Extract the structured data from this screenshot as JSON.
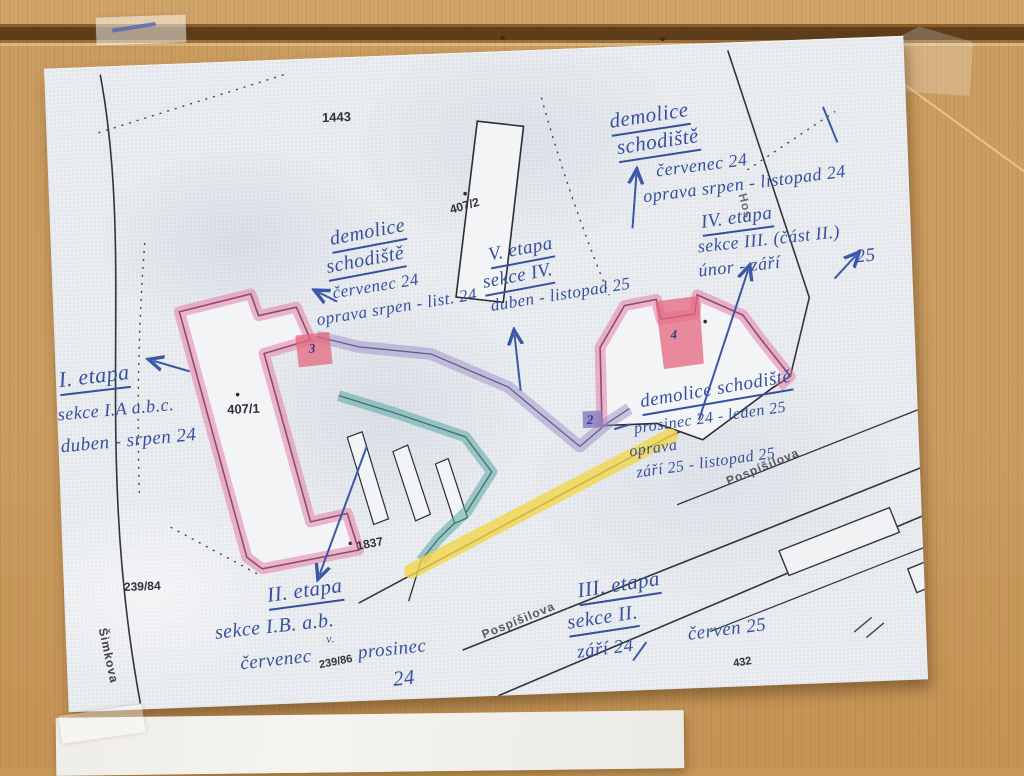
{
  "photo": {
    "wood_color": "#c79758",
    "paper_color": "#edeff1"
  },
  "map": {
    "parcels": [
      {
        "label": "1443"
      },
      {
        "label": "407/2"
      },
      {
        "label": "407/1"
      },
      {
        "label": "1837"
      },
      {
        "label": "239/84"
      },
      {
        "label": "239/86"
      },
      {
        "label": "432"
      }
    ],
    "streets": [
      {
        "name": "Šimkova"
      },
      {
        "name": "Pospíšilova"
      },
      {
        "name": "Pospíšilova"
      },
      {
        "name": "Hos"
      }
    ],
    "stair_markers": [
      {
        "num": "3"
      },
      {
        "num": "4"
      },
      {
        "num": "2"
      }
    ],
    "legend_colors": {
      "pink": "#e671a2",
      "red": "#e4677e",
      "lavender": "#9c8fc9",
      "teal": "#58a8a2",
      "yellow": "#f3d64a",
      "ink": "#3a57a8"
    }
  },
  "annotations": {
    "a1": {
      "l1": "demolice",
      "l2": "schodiště",
      "l3": "červenec 24",
      "l4": "oprava srpen - listopad 24"
    },
    "a2": {
      "l1": "demolice",
      "l2": "schodiště",
      "l3": "červenec 24",
      "l4": "oprava srpen - list. 24"
    },
    "a3": {
      "l1": "V. etapa",
      "l2": "sekce IV.",
      "l3": "duben - listopad 25"
    },
    "a4": {
      "l1": "IV. etapa",
      "l2": "sekce III. (část II.)",
      "l3": "únor - září",
      "l4": "25"
    },
    "a5": {
      "l1": "I. etapa",
      "l2": "sekce I.A a.b.c.",
      "l3": "duben - srpen 24"
    },
    "a6": {
      "l1": "demolice schodiště",
      "l2": "prosinec 24 - leden 25",
      "l3": "oprava",
      "l4": "září 25 - listopad 25"
    },
    "a7": {
      "l1": "II. etapa",
      "l2": "sekce I.B. a.b.",
      "l3": "červenec",
      "check": "v.",
      "l4": "prosinec",
      "l5": "24"
    },
    "a8": {
      "l1": "III. etapa",
      "l2": "sekce II.",
      "l3": "září 24",
      "l4": "červen 25"
    }
  }
}
